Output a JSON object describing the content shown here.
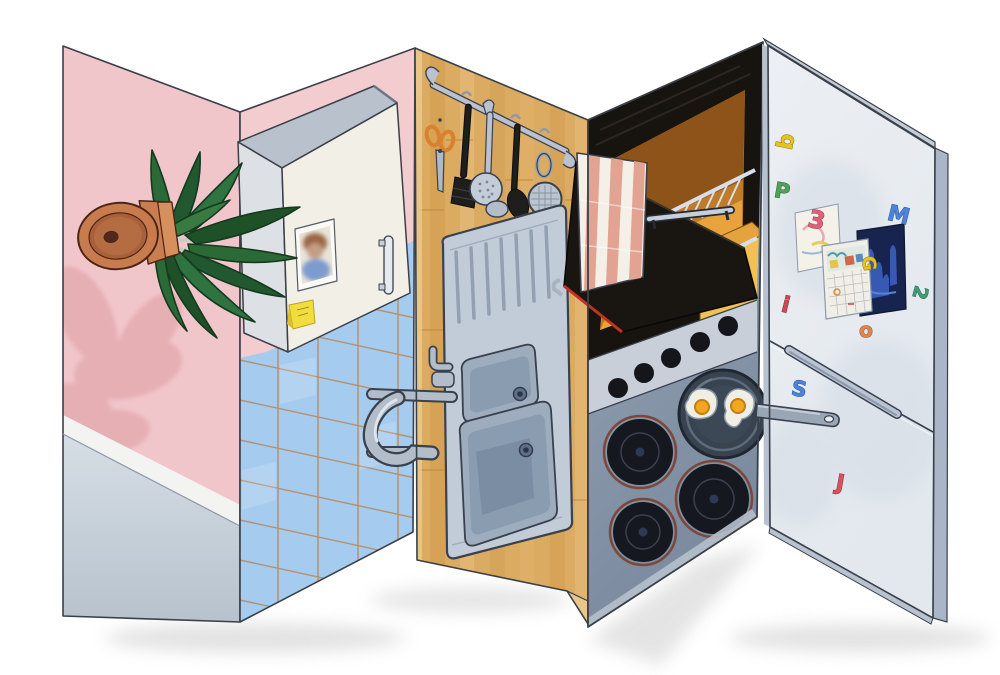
{
  "artwork": {
    "kind": "folded shaped painting of a kitchen interior",
    "panels": [
      {
        "id": "pink-wall",
        "depicts": "pink wall with plant shadow and tilted potted plant"
      },
      {
        "id": "cabinet-wall",
        "depicts": "white wall cabinet with photo and sticky note over blue tiles"
      },
      {
        "id": "wood-wall",
        "depicts": "butcher-block wall with utensil rail and double steel sink"
      },
      {
        "id": "stove",
        "depicts": "open oven with striped towel, knobs, burners and frying pan with eggs"
      },
      {
        "id": "fridge",
        "depicts": "fridge-freezer door with magnet letters, drawing, calendar and blue photo"
      }
    ],
    "palette": {
      "pink_wall": "#f1c6cb",
      "pink_shadow": "#e4abb0",
      "tile_blue": "#a5cbee",
      "tile_grout": "#b5906c",
      "wood": "#dcab62",
      "metal_light": "#b6c0cd",
      "oven_black": "#17140f",
      "oven_interior": "#e8a33c",
      "towel_stripe": "#e2a392",
      "stove_grey": "#8ea0b8",
      "fridge_face": "#e9edf2",
      "egg_yolk": "#f2a71f",
      "outline": "#3a4048"
    }
  },
  "fridge": {
    "magnets": [
      {
        "char": "b",
        "x": 793,
        "y": 143,
        "rot": -78,
        "size": 22,
        "fill": "#e7c31f",
        "stroke": "#8a7210"
      },
      {
        "char": "P",
        "x": 781,
        "y": 198,
        "rot": 10,
        "size": 21,
        "fill": "#4fa05a",
        "stroke": "#2c6434"
      },
      {
        "char": "3",
        "x": 815,
        "y": 228,
        "rot": 12,
        "size": 24,
        "fill": "#e2607a",
        "stroke": "#9c3350"
      },
      {
        "char": "M",
        "x": 897,
        "y": 222,
        "rot": 14,
        "size": 22,
        "fill": "#4f83d6",
        "stroke": "#2c55a0"
      },
      {
        "char": "G",
        "x": 863,
        "y": 264,
        "rot": 85,
        "size": 18,
        "fill": "#e7c31f",
        "stroke": "#8a7210"
      },
      {
        "char": "2",
        "x": 914,
        "y": 291,
        "rot": 105,
        "size": 19,
        "fill": "#3f9d74",
        "stroke": "#246148"
      },
      {
        "char": "i",
        "x": 784,
        "y": 312,
        "rot": 14,
        "size": 22,
        "fill": "#cc4a55",
        "stroke": "#8a2830"
      },
      {
        "char": "o",
        "x": 866,
        "y": 337,
        "rot": 0,
        "size": 20,
        "fill": "#e0854f",
        "stroke": "#a0522a"
      },
      {
        "char": "S",
        "x": 798,
        "y": 396,
        "rot": 10,
        "size": 21,
        "fill": "#4f83d6",
        "stroke": "#2c55a0"
      },
      {
        "char": "J",
        "x": 839,
        "y": 490,
        "rot": 10,
        "size": 22,
        "fill": "#d6525f",
        "stroke": "#99303c"
      }
    ]
  }
}
